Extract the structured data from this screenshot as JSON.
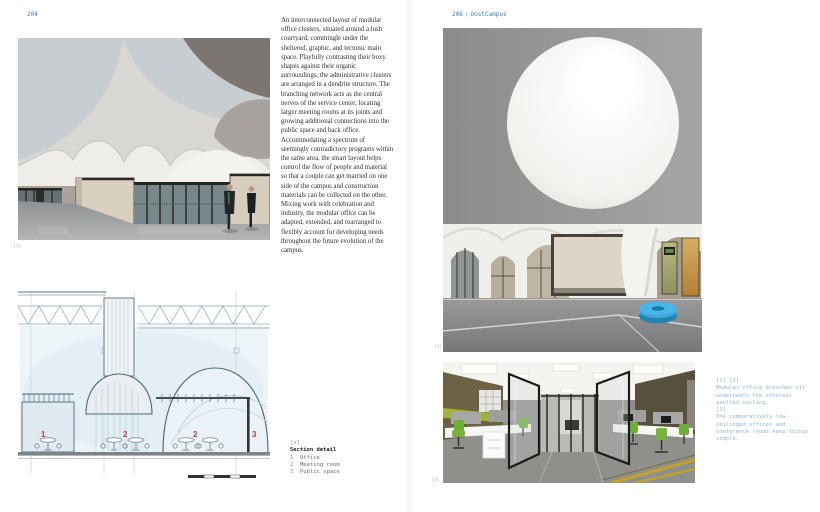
{
  "accent": {
    "blue": "#3d7fba",
    "caption_blue": "#97b5ca",
    "red": "#b5443a"
  },
  "left_page": {
    "page_number": "204",
    "body_text": "An interconnected layout of modular office clusters, situated around a lush courtyard, commingle under the sheltered, graphic, and tectonic main space. Playfully contrasting their boxy shapes against their organic surroundings, the administrative clusters are arranged in a dendrite structure. The branching network acts as the central nerves of the service center, locating larger meeting rooms at its joints and growing additional connections into the public space and back office. Accommodating a spectrum of seemingly contradictory programs within the same area, the smart layout helps control the flow of people and material so that a couple can get married on one side of the campus and construction materials can be collected on the other. Mixing work with celebration and industry, the modular office can be adapted, extended, and rearranged to flexibly account for developing needs throughout the future evolution of the campus.",
    "photo1_label": "[1]",
    "drawing_caption": {
      "mark": "[a]",
      "title": "Section detail",
      "legend": [
        {
          "num": "1",
          "label": "Office"
        },
        {
          "num": "2",
          "label": "Meeting room"
        },
        {
          "num": "3",
          "label": "Public space"
        }
      ]
    },
    "drawing_labels": [
      "1",
      "2",
      "2",
      "3"
    ]
  },
  "right_page": {
    "page_number": "206",
    "separator": "|",
    "project_name": "OostCampus",
    "photo2_label": "[2]",
    "photo3_label": "[3]",
    "caption": {
      "refs1": "[1] [2]",
      "text1": "Modular office branches sit underneath the ethereal vaulted ceiling.",
      "refs2": "[3]",
      "text2": "The comparatively low-ceilinged offices and conference rooms keep things simple."
    }
  }
}
